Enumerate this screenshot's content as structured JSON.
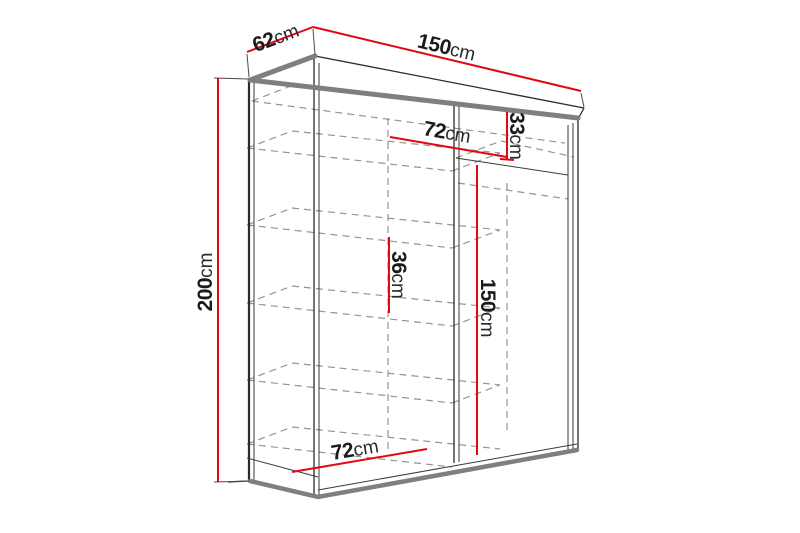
{
  "diagram": {
    "type": "furniture-dimension-drawing",
    "subject": "two-door sliding wardrobe, open front showing shelves and hanging section"
  },
  "colors": {
    "dimension_red": "#e30613",
    "outline_black": "#2b2b2b",
    "panel_gray": "#7f7f7f",
    "hidden_dash_gray": "#949494",
    "background": "#ffffff",
    "label_text": "#1b1b1b"
  },
  "dimensions": {
    "depth_top": {
      "value": "62",
      "unit": "cm"
    },
    "width_top": {
      "value": "150",
      "unit": "cm"
    },
    "height_left": {
      "value": "200",
      "unit": "cm"
    },
    "shelf_width_upper": {
      "value": "72",
      "unit": "cm"
    },
    "top_gap_height": {
      "value": "33",
      "unit": "cm"
    },
    "shelf_gap_height": {
      "value": "36",
      "unit": "cm"
    },
    "hanging_height": {
      "value": "150",
      "unit": "cm"
    },
    "shelf_width_lower": {
      "value": "72",
      "unit": "cm"
    }
  }
}
